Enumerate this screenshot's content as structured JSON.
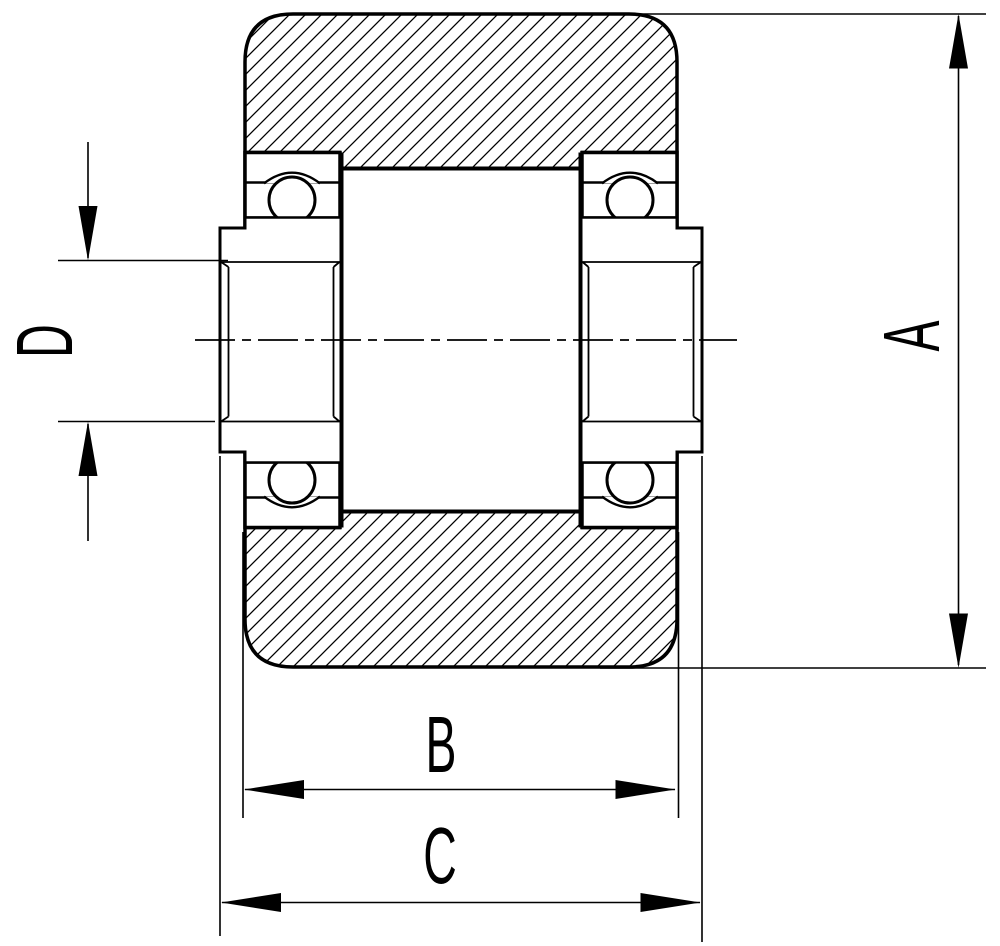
{
  "drawing": {
    "subject": "wheel-roller-cross-section-with-two-ball-bearings",
    "view": "sectional front view, hatched wheel body, horizontal axle centerline",
    "background_color": "#ffffff",
    "line_color": "#000000",
    "hatch_color": "#000000"
  },
  "dimensions": [
    {
      "label": "A",
      "axis": "vertical",
      "position": "right",
      "extent": "overall outer diameter of wheel"
    },
    {
      "label": "B",
      "axis": "horizontal",
      "position": "bottom",
      "extent": "width across wheel faces"
    },
    {
      "label": "C",
      "axis": "horizontal",
      "position": "bottom",
      "extent": "overall width across bearing inner rings"
    },
    {
      "label": "D",
      "axis": "vertical",
      "position": "left",
      "extent": "bore diameter of bearing inner ring"
    }
  ]
}
